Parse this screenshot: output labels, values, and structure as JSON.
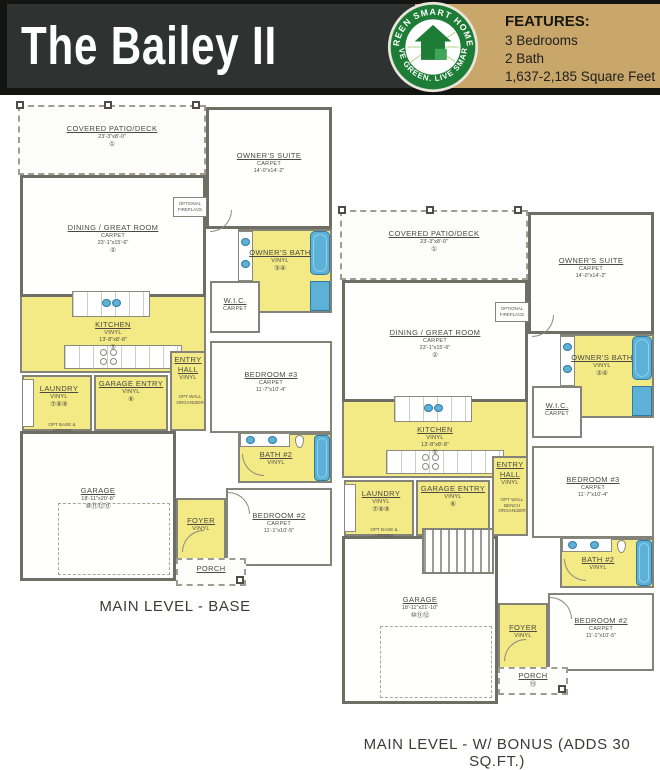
{
  "header": {
    "title": "The Bailey II",
    "features": {
      "heading": "FEATURES:",
      "items": [
        "3 Bedrooms",
        "2 Bath",
        "1,637-2,185 Square Feet"
      ]
    },
    "logo": {
      "arc_top": "GREEN SMART HOMES",
      "arc_bottom": "LIVE GREEN. LIVE SMART."
    },
    "colors": {
      "bar": "#2e3231",
      "panel": "#c9a76a",
      "logo_green": "#1d7c35"
    }
  },
  "plans": [
    {
      "caption": "MAIN LEVEL - BASE",
      "rooms": {
        "patio": {
          "name": "COVERED PATIO/DECK",
          "dims": "23'-3\"x8'-0\"",
          "note": "①"
        },
        "suite": {
          "name": "OWNER'S SUITE",
          "floor": "CARPET",
          "dims": "14'-0\"x14'-2\""
        },
        "dining": {
          "name": "DINING / GREAT ROOM",
          "floor": "CARPET",
          "dims": "23'-1\"x15'-6\"",
          "note": "②"
        },
        "fireplace": {
          "name": "OPTIONAL FIREPLACE"
        },
        "obath": {
          "name": "OWNER'S BATH",
          "floor": "VINYL",
          "note": "③④"
        },
        "wic": {
          "name": "W.I.C.",
          "floor": "CARPET"
        },
        "kitchen": {
          "name": "KITCHEN",
          "floor": "VINYL",
          "dims": "13'-8\"x8'-8\"",
          "note": "⑤"
        },
        "entry": {
          "name": "ENTRY HALL",
          "floor": "VINYL"
        },
        "gentry": {
          "name": "GARAGE ENTRY",
          "floor": "VINYL",
          "note": "⑥"
        },
        "laundry": {
          "name": "LAUNDRY",
          "floor": "VINYL",
          "note": "⑦⑧⑨"
        },
        "optwall": {
          "name": "OPT WALL ORGANIZER"
        },
        "bed3": {
          "name": "BEDROOM #3",
          "floor": "CARPET",
          "dims": "11'-7\"x10'-4\""
        },
        "bath2": {
          "name": "BATH #2",
          "floor": "VINYL"
        },
        "garage": {
          "name": "GARAGE",
          "dims": "18'-11\"x20'-8\"",
          "note": "⑩⑪⑫⑬"
        },
        "optbase": {
          "name": "OPT BASE & UPPERS"
        },
        "foyer": {
          "name": "FOYER",
          "floor": "VINYL"
        },
        "bed2": {
          "name": "BEDROOM #2",
          "floor": "CARPET",
          "dims": "11'-1\"x10'-5\""
        },
        "porch": {
          "name": "PORCH"
        }
      }
    },
    {
      "caption": "MAIN LEVEL - W/ BONUS (ADDS 30 SQ.FT.)",
      "rooms": {
        "patio": {
          "name": "COVERED PATIO/DECK",
          "dims": "23'-3\"x8'-0\"",
          "note": "①"
        },
        "suite": {
          "name": "OWNER'S SUITE",
          "floor": "CARPET",
          "dims": "14'-0\"x14'-2\""
        },
        "dining": {
          "name": "DINING / GREAT ROOM",
          "floor": "CARPET",
          "dims": "23'-1\"x15'-6\"",
          "note": "②"
        },
        "fireplace": {
          "name": "OPTIONAL FIREPLACE"
        },
        "obath": {
          "name": "OWNER'S BATH",
          "floor": "VINYL",
          "note": "③④"
        },
        "wic": {
          "name": "W.I.C.",
          "floor": "CARPET"
        },
        "kitchen": {
          "name": "KITCHEN",
          "floor": "VINYL",
          "dims": "13'-8\"x8'-8\"",
          "note": "⑤"
        },
        "entry": {
          "name": "ENTRY HALL",
          "floor": "VINYL"
        },
        "gentry": {
          "name": "GARAGE ENTRY",
          "floor": "VINYL",
          "note": "⑥"
        },
        "laundry": {
          "name": "LAUNDRY",
          "floor": "VINYL",
          "note": "⑦⑧⑨"
        },
        "optwall": {
          "name": "OPT WALL BENCH ORGANIZER"
        },
        "bed3": {
          "name": "BEDROOM #3",
          "floor": "CARPET",
          "dims": "11'-7\"x10'-4\""
        },
        "bath2": {
          "name": "BATH #2",
          "floor": "VINYL"
        },
        "garage": {
          "name": "GARAGE",
          "dims": "18'-11\"x21'-10\"",
          "note": "⑩⑪⑫"
        },
        "optbase": {
          "name": "OPT BASE & UPPERS"
        },
        "foyer": {
          "name": "FOYER",
          "floor": "VINYL"
        },
        "bed2": {
          "name": "BEDROOM #2",
          "floor": "CARPET",
          "dims": "11'-1\"x10'-5\""
        },
        "porch": {
          "name": "PORCH",
          "note": "⑬"
        }
      }
    }
  ]
}
